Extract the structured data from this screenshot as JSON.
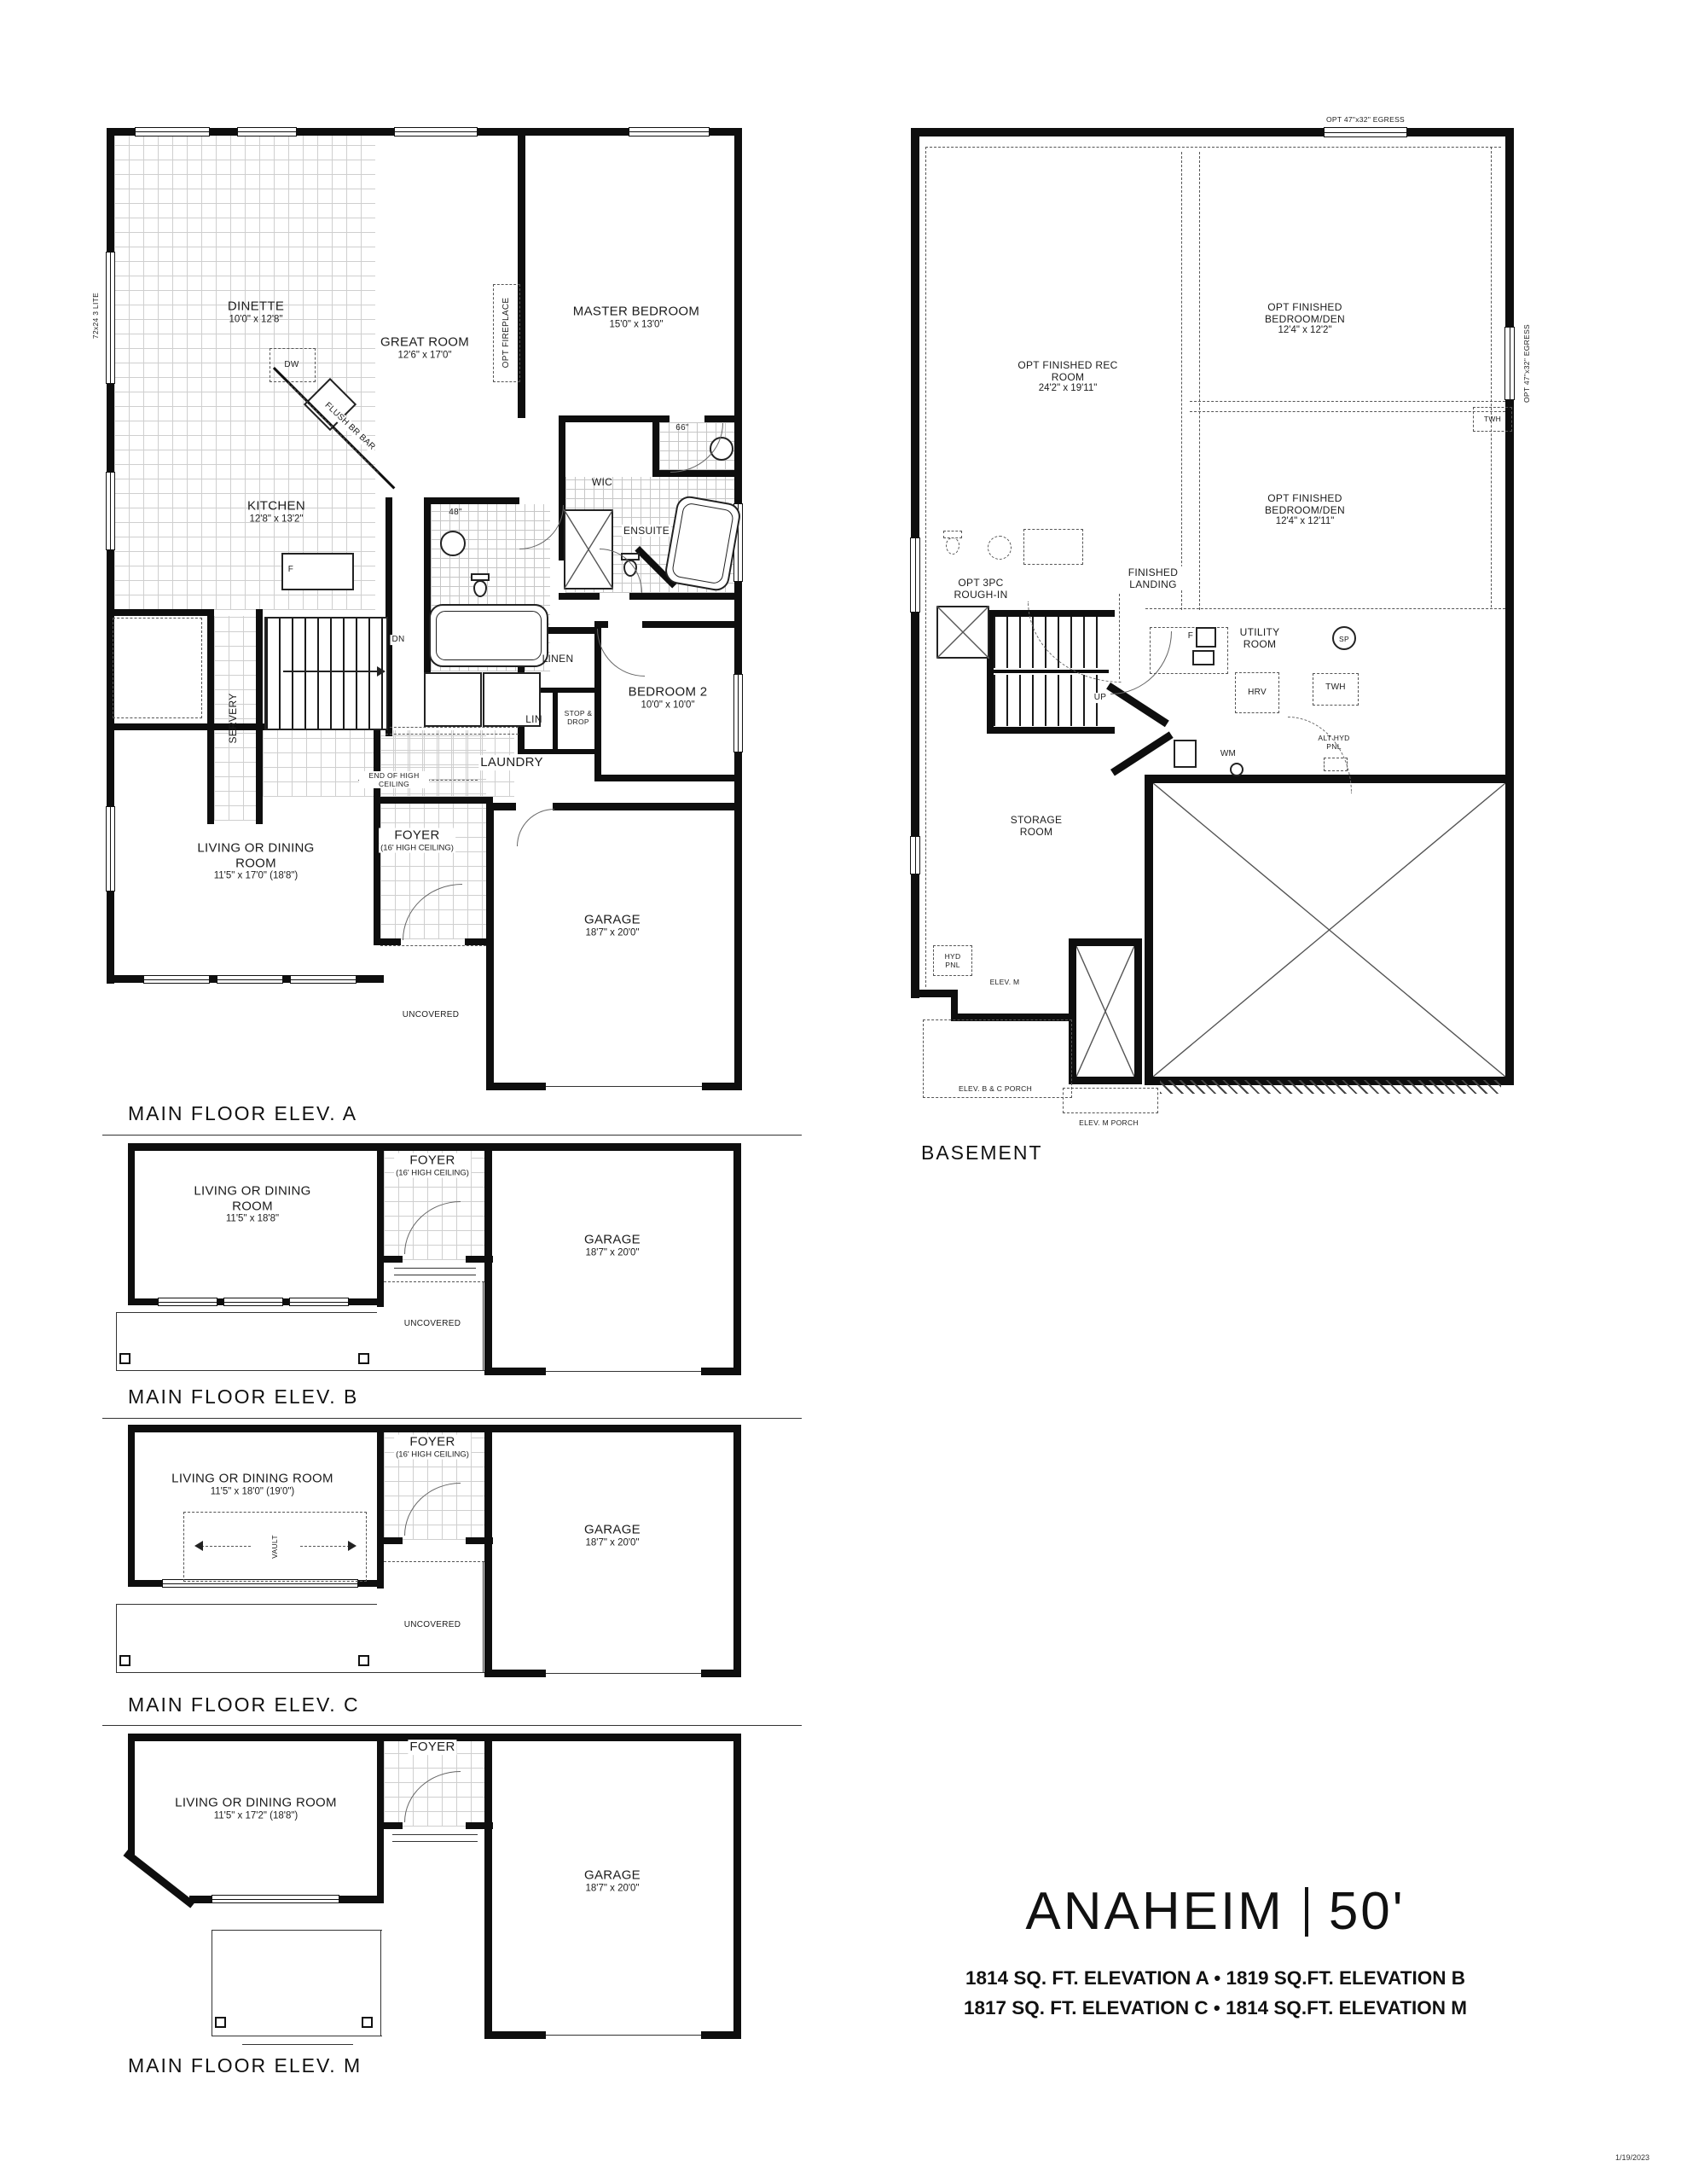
{
  "sheet": {
    "title": {
      "model": "ANAHEIM",
      "frontage": "50'",
      "specs_line1": "1814 SQ. FT. ELEVATION A • 1819 SQ.FT. ELEVATION B",
      "specs_line2": "1817 SQ. FT. ELEVATION C • 1814 SQ.FT. ELEVATION M"
    },
    "date_stamp": "1/19/2023"
  },
  "plan_a": {
    "label": "MAIN FLOOR ELEV. A",
    "rooms": {
      "dinette": {
        "name": "DINETTE",
        "dims": "10'0\" x 12'8\""
      },
      "great": {
        "name": "GREAT ROOM",
        "dims": "12'6\" x 17'0\""
      },
      "master": {
        "name": "MASTER BEDROOM",
        "dims": "15'0\" x 13'0\""
      },
      "kitchen": {
        "name": "KITCHEN",
        "dims": "12'8\" x 13'2\""
      },
      "bed2": {
        "name": "BEDROOM 2",
        "dims": "10'0\" x 10'0\""
      },
      "living": {
        "name": "LIVING OR DINING ROOM",
        "dims": "11'5\" x 17'0\" (18'8\")"
      },
      "garage": {
        "name": "GARAGE",
        "dims": "18'7\" x 20'0\""
      },
      "foyer": {
        "name": "FOYER",
        "note": "(16' HIGH CEILING)"
      },
      "wic": "WIC",
      "ensuite": "ENSUITE",
      "servery": "SERVERY",
      "laundry": "LAUNDRY",
      "linen": "LINEN",
      "lin": "LIN",
      "stopdrop": "STOP & DROP",
      "uncovered": "UNCOVERED"
    },
    "ann": {
      "lite": "72x24 3 LITE",
      "fireplace": "OPT FIREPLACE",
      "flushbar": "FLUSH BR BAR",
      "dw": "DW",
      "fridge": "F",
      "dn": "DN",
      "b48": "48\"",
      "b66": "66\"",
      "endhigh": "END OF HIGH CEILING"
    }
  },
  "basement": {
    "label": "BASEMENT",
    "rooms": {
      "rec": {
        "name": "OPT FINISHED REC ROOM",
        "dims": "24'2\" x 19'11\""
      },
      "den1": {
        "name": "OPT FINISHED BEDROOM/DEN",
        "dims": "12'4\" x 12'2\""
      },
      "den2": {
        "name": "OPT FINISHED BEDROOM/DEN",
        "dims": "12'4\" x 12'11\""
      },
      "utility": "UTILITY ROOM",
      "storage": "STORAGE ROOM",
      "roughin": "OPT 3PC ROUGH-IN",
      "landing": "FINISHED LANDING"
    },
    "ann": {
      "egress_top": "OPT 47\"x32\" EGRESS",
      "egress_right": "OPT 47\"x32\" EGRESS",
      "up": "UP",
      "sp": "SP",
      "furnace": "F",
      "hrv": "HRV",
      "twh": "TWH",
      "twh2": "TWH",
      "althyd": "ALT HYD PNL",
      "wm": "WM",
      "hydpnl": "HYD PNL",
      "elevm": "ELEV. M",
      "porch_bc": "ELEV. B & C PORCH",
      "porch_m": "ELEV. M PORCH"
    }
  },
  "plan_b": {
    "label": "MAIN FLOOR ELEV. B",
    "rooms": {
      "living": {
        "name": "LIVING OR DINING ROOM",
        "dims": "11'5\" x 18'8\""
      },
      "foyer": {
        "name": "FOYER",
        "note": "(16' HIGH CEILING)"
      },
      "garage": {
        "name": "GARAGE",
        "dims": "18'7\" x 20'0\""
      },
      "uncovered": "UNCOVERED"
    }
  },
  "plan_c": {
    "label": "MAIN FLOOR ELEV. C",
    "rooms": {
      "living": {
        "name": "LIVING OR DINING ROOM",
        "dims": "11'5\" x 18'0\" (19'0\")"
      },
      "foyer": {
        "name": "FOYER",
        "note": "(16' HIGH CEILING)"
      },
      "garage": {
        "name": "GARAGE",
        "dims": "18'7\" x 20'0\""
      },
      "uncovered": "UNCOVERED",
      "vault": "VAULT"
    }
  },
  "plan_m": {
    "label": "MAIN FLOOR ELEV. M",
    "rooms": {
      "living": {
        "name": "LIVING OR DINING ROOM",
        "dims": "11'5\" x 17'2\" (18'8\")"
      },
      "foyer": {
        "name": "FOYER"
      },
      "garage": {
        "name": "GARAGE",
        "dims": "18'7\" x 20'0\""
      }
    }
  }
}
